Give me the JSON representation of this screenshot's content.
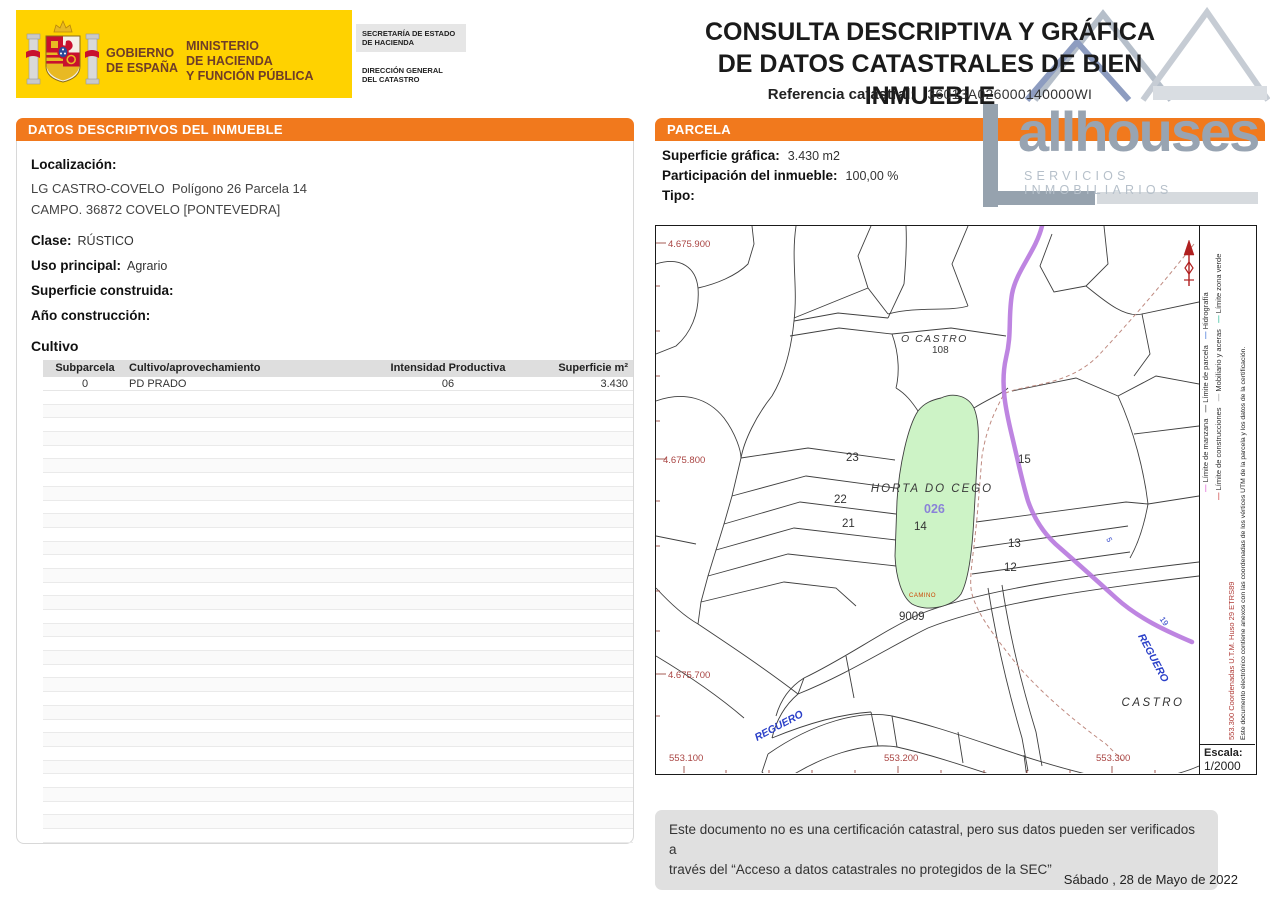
{
  "colors": {
    "accent_orange": "#f1791d",
    "banner_yellow": "#ffd200",
    "parcel_green": "#cdf3c6",
    "stream_purple": "#b778de",
    "coord_red": "#a94442",
    "hydro_blue": "#2a3fc8"
  },
  "header": {
    "gobierno_line1": "GOBIERNO",
    "gobierno_line2": "DE ESPAÑA",
    "ministerio_line1": "MINISTERIO",
    "ministerio_line2": "DE HACIENDA",
    "ministerio_line3": "Y FUNCIÓN PÚBLICA",
    "secretaria": "SECRETARÍA DE ESTADO DE HACIENDA",
    "direccion_line1": "DIRECCIÓN GENERAL",
    "direccion_line2": "DEL CATASTRO"
  },
  "title": {
    "line1": "CONSULTA DESCRIPTIVA Y GRÁFICA",
    "line2": "DE DATOS CATASTRALES DE BIEN INMUEBLE",
    "ref_label": "Referencia catastral:",
    "ref_value": "36013A026000140000WI"
  },
  "logo": {
    "name": "allhouses",
    "tagline": "SERVICIOS INMOBILIARIOS"
  },
  "left_panel": {
    "header_prefix": "DATOS DESCRIPTIVOS DEL ",
    "header_emphasis": "INMUEBLE",
    "localizacion_label": "Localización:",
    "address_line1": "LG CASTRO-COVELO  Polígono 26 Parcela 14",
    "address_line2": "CAMPO. 36872 COVELO [PONTEVEDRA]",
    "clase_label": "Clase:",
    "clase_value": "RÚSTICO",
    "uso_label": "Uso principal:",
    "uso_value": "Agrario",
    "superficie_label": "Superficie construida:",
    "superficie_value": "",
    "anio_label": "Año construcción:",
    "anio_value": "",
    "cultivo_title": "Cultivo",
    "table": {
      "headers": [
        "Subparcela",
        "Cultivo/aprovechamiento",
        "Intensidad Productiva",
        "Superficie m²"
      ],
      "rows": [
        [
          "0",
          "PD PRADO",
          "06",
          "3.430"
        ]
      ],
      "empty_row_count": 33
    }
  },
  "right_panel": {
    "header": "PARCELA",
    "superficie_grafica_label": "Superficie gráfica:",
    "superficie_grafica_value": "3.430 m2",
    "participacion_label": "Participación del inmueble:",
    "participacion_value": "100,00 %",
    "tipo_label": "Tipo:",
    "tipo_value": "",
    "map": {
      "coord_labels": {
        "y_900": "4.675.900",
        "y_800": "4.675.800",
        "y_700": "4.675.700",
        "x_100": "553.100",
        "x_200": "553.200",
        "x_300": "553.300"
      },
      "place_labels": {
        "o_castro": "O CASTRO",
        "n_108": "108",
        "horta_do_cego": "HORTA DO CEGO",
        "parcel_code": "026",
        "camino": "CAMINO",
        "reguero_sw": "REGUERO",
        "reguero_e": "REGUERO",
        "castro": "CASTRO"
      },
      "parcel_numbers": {
        "p23": "23",
        "p22": "22",
        "p21": "21",
        "p15": "15",
        "p14": "14",
        "p13": "13",
        "p12": "12",
        "p9009": "9009",
        "p5": "5",
        "p19": "19"
      },
      "legend": {
        "coordinates_note": "553.300 Coordenadas U.T.M. Huso 29 ETRS89",
        "certification_note": "Este documento electrónico contiene anexos con las coordenadas de los vértices UTM de la parcela y los datos de la certificación.",
        "line1": [
          {
            "label": "Límite de manzana",
            "color": "#e06ad8"
          },
          {
            "label": "Límite de parcela",
            "color": "#555555"
          },
          {
            "label": "Hidrografía",
            "color": "#4a7ad8"
          }
        ],
        "line2": [
          {
            "label": "Límite de construcciones",
            "color": "#d05050"
          },
          {
            "label": "Mobiliario y aceras",
            "color": "#aaaaaa"
          },
          {
            "label": "Límite zona verde",
            "color": "#3cc0a0"
          }
        ]
      },
      "escala_label": "Escala:",
      "escala_value": "1/2000"
    }
  },
  "footer": {
    "disclaimer_line1": "Este documento no es una certificación catastral, pero sus datos pueden ser verificados a",
    "disclaimer_line2": "través del “Acceso a datos catastrales no protegidos de la SEC”",
    "date": "Sábado , 28 de Mayo de 2022"
  }
}
